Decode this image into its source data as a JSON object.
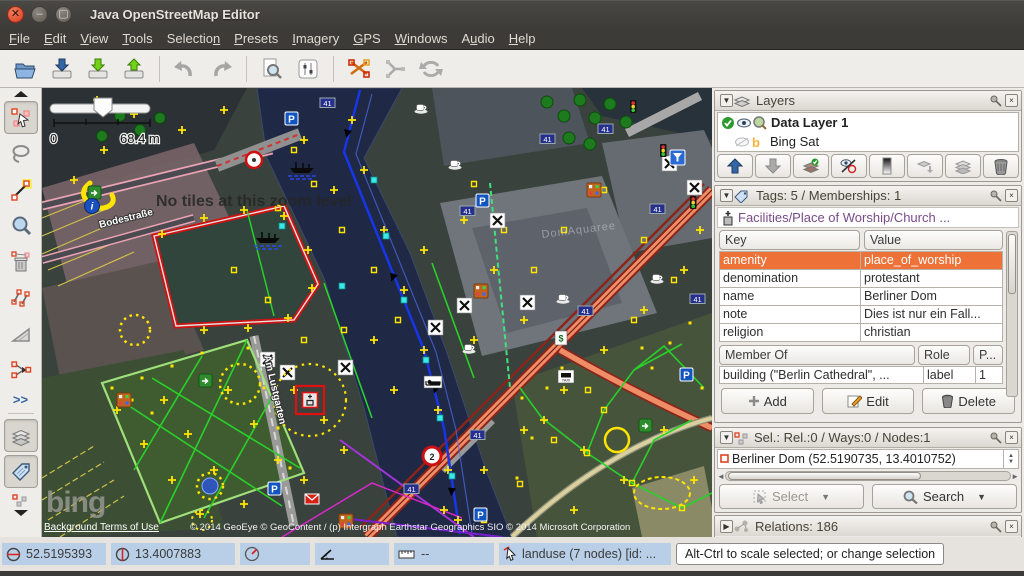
{
  "window": {
    "title": "Java OpenStreetMap Editor"
  },
  "menu": {
    "items": [
      {
        "pre": "",
        "key": "F",
        "post": "ile"
      },
      {
        "pre": "",
        "key": "E",
        "post": "dit"
      },
      {
        "pre": "",
        "key": "V",
        "post": "iew"
      },
      {
        "pre": "",
        "key": "T",
        "post": "ools"
      },
      {
        "pre": "Selectio",
        "key": "n",
        "post": ""
      },
      {
        "pre": "",
        "key": "P",
        "post": "resets"
      },
      {
        "pre": "",
        "key": "I",
        "post": "magery"
      },
      {
        "pre": "",
        "key": "G",
        "post": "PS"
      },
      {
        "pre": "",
        "key": "W",
        "post": "indows"
      },
      {
        "pre": "A",
        "key": "u",
        "post": "dio"
      },
      {
        "pre": "",
        "key": "H",
        "post": "elp"
      }
    ]
  },
  "toolbar": {
    "icons": [
      "open",
      "save",
      "download-data",
      "upload-data",
      "undo",
      "redo",
      "download-object",
      "preferences",
      "split-way",
      "combine-way",
      "refresh"
    ]
  },
  "side_toolbar": {
    "tools": [
      "collapse",
      "select",
      "lasso",
      "draw-nodes",
      "zoom",
      "delete",
      "parallel-way",
      "angle-snap",
      "merge-nodes",
      "more",
      "layers-toggle",
      "tags-toggle",
      "selection-toggle"
    ]
  },
  "map": {
    "no_tiles_message": "No tiles at this zoom level",
    "scale": {
      "start": "0",
      "end": "68.4 m"
    },
    "streets": {
      "street1": "Bodestraße",
      "street2": "Am Lustgarten"
    },
    "area_label": "DomAquaree",
    "bing_logo": "bing",
    "terms_link": "Background Terms of Use",
    "copyright": "© 2014 GeoEye © GeoContent / (p) Intergraph Earthstar Geographics SIO © 2014 Microsoft Corporation",
    "glyphs": {
      "parking": "P",
      "route41": "41",
      "roundel": "2",
      "taxi": "TAXI",
      "bank": "$"
    }
  },
  "layers_panel": {
    "title": "Layers",
    "layers": [
      {
        "name": "Data Layer 1"
      },
      {
        "name": "Bing Sat"
      }
    ],
    "buttons": [
      "move-up",
      "move-down",
      "activate",
      "show-hide",
      "opacity",
      "merge-down",
      "duplicate",
      "delete-layer"
    ]
  },
  "tags_panel": {
    "title": "Tags: 5 / Memberships: 1",
    "preset": "Facilities/Place of Worship/Church ...",
    "columns": {
      "key": "Key",
      "value": "Value"
    },
    "rows": [
      {
        "key": "amenity",
        "value": "place_of_worship"
      },
      {
        "key": "denomination",
        "value": "protestant"
      },
      {
        "key": "name",
        "value": "Berliner Dom"
      },
      {
        "key": "note",
        "value": "Dies ist nur ein Fall..."
      },
      {
        "key": "religion",
        "value": "christian"
      }
    ],
    "selected_row": 0,
    "membership_columns": {
      "member_of": "Member Of",
      "role": "Role",
      "position": "P..."
    },
    "memberships": [
      {
        "relation": "building (\"Berlin Cathedral\", ...",
        "role": "label",
        "position": "1"
      }
    ],
    "buttons": {
      "add": "Add",
      "edit": "Edit",
      "delete": "Delete"
    }
  },
  "selection_panel": {
    "title": "Sel.: Rel.:0 / Ways:0 / Nodes:1",
    "items": [
      {
        "label": "Berliner Dom (52.5190735, 13.4010752)"
      }
    ],
    "buttons": {
      "select": "Select",
      "search": "Search"
    }
  },
  "relations_panel": {
    "title": "Relations: 186"
  },
  "status_bar": {
    "lat": "52.5195393",
    "lon": "13.4007883",
    "distance": "--",
    "object_info": "landuse (7 nodes) [id: ...",
    "hint": "Alt-Ctrl to scale selected; or change selection"
  }
}
